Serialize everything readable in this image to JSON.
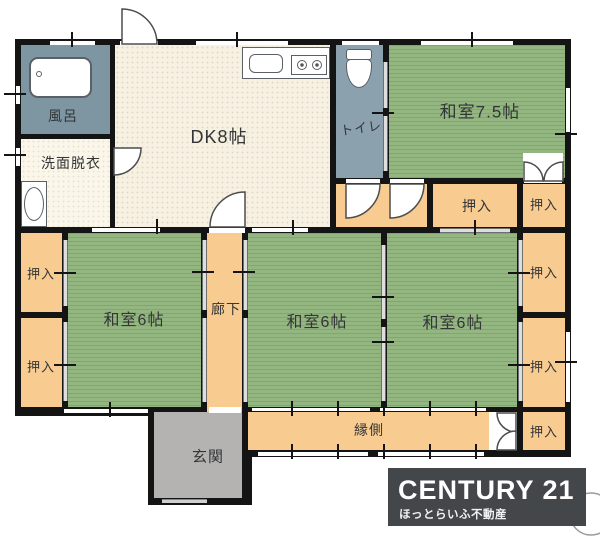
{
  "rooms": {
    "bath": "風呂",
    "washroom": "洗面脱衣",
    "dining_kitchen": "DK8帖",
    "toilet": "トイレ",
    "japanese_room_75": "和室7.5帖",
    "japanese_room_6_left": "和室6帖",
    "japanese_room_6_middle": "和室6帖",
    "japanese_room_6_right": "和室6帖",
    "corridor": "廊下",
    "entrance": "玄関",
    "veranda": "縁側"
  },
  "closets": [
    "押入",
    "押入",
    "押入",
    "押入",
    "押入",
    "押入",
    "押入"
  ],
  "logo": {
    "brand": "CENTURY 21",
    "company": "ほっとらいふ不動産",
    "background": "#44474a",
    "text_color": "#ffffff"
  },
  "colors": {
    "tatami_green": "#94b781",
    "closet_orange": "#f8cb90",
    "dk_cream": "#f6f1e2",
    "bath_teal": "#7e95a2",
    "toilet_teal": "#8ba1ad",
    "entrance_gray": "#b4b3b1",
    "wall_black": "#141414"
  }
}
